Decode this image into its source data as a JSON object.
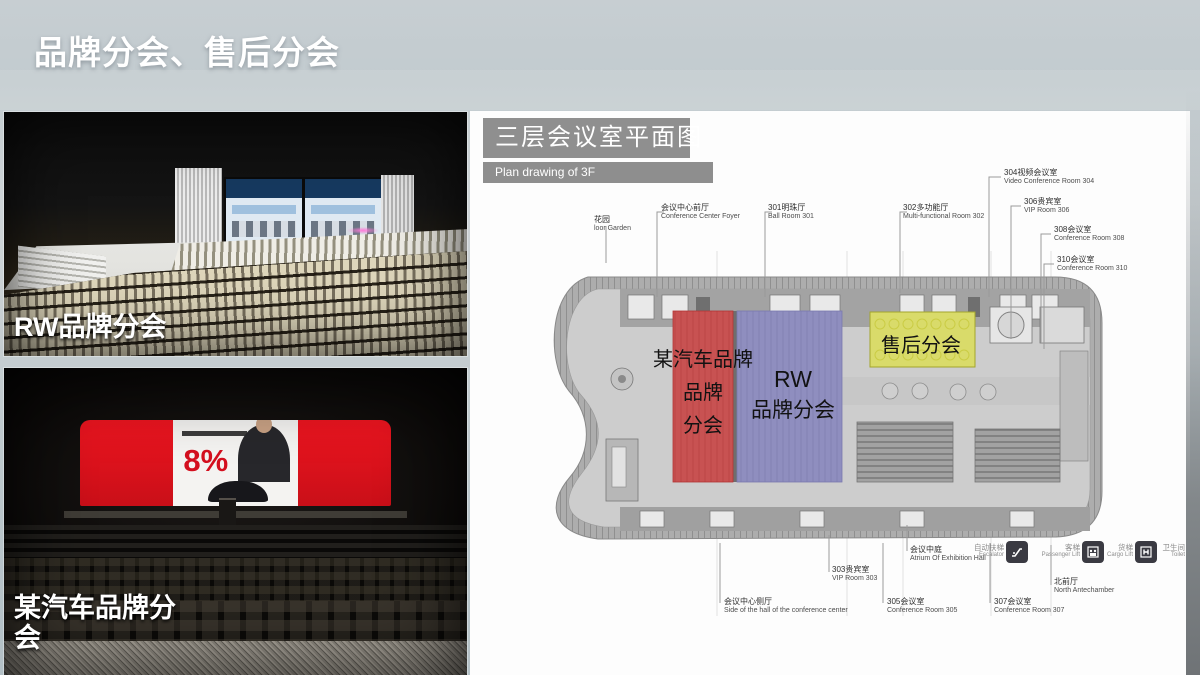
{
  "slide": {
    "title": "品牌分会、售后分会"
  },
  "photos": {
    "rw": {
      "label": "RW品牌分会"
    },
    "brand": {
      "label": "某汽车品牌分会",
      "screen_stat": "8%"
    }
  },
  "plan": {
    "title_zh": "三层会议室平面图",
    "title_en": "Plan drawing of 3F",
    "regions": {
      "brand": {
        "lines": [
          "某汽车品牌",
          "品牌",
          "分会"
        ],
        "color": "#d54e4e"
      },
      "rw": {
        "lines": [
          "RW",
          "品牌分会"
        ],
        "color": "#8f8ec8"
      },
      "after_sales": {
        "lines": [
          "售后分会"
        ],
        "color": "#dde04f"
      }
    },
    "labels": {
      "garden": {
        "zh": "花园",
        "en": "loor Garden"
      },
      "foyer": {
        "zh": "会议中心前厅",
        "en": "Conference Center Foyer"
      },
      "room301": {
        "zh": "301明珠厅",
        "en": "Ball Room 301"
      },
      "room302": {
        "zh": "302多功能厅",
        "en": "Multi-functional Room 302"
      },
      "room304": {
        "zh": "304视频会议室",
        "en": "Video Conference Room 304"
      },
      "room306": {
        "zh": "306贵宾室",
        "en": "VIP Room 306"
      },
      "room308": {
        "zh": "308会议室",
        "en": "Conference Room 308"
      },
      "room310": {
        "zh": "310会议室",
        "en": "Conference Room 310"
      },
      "side_hall": {
        "zh": "会议中心侧厅",
        "en": "Side of the hall of the conference center"
      },
      "room303": {
        "zh": "303贵宾室",
        "en": "VIP Room 303"
      },
      "room305": {
        "zh": "305会议室",
        "en": "Conference Room 305"
      },
      "atrium": {
        "zh": "会议中庭",
        "en": "Atrium Of Exhibition Hall"
      },
      "room307": {
        "zh": "307会议室",
        "en": "Conference Room 307"
      },
      "north": {
        "zh": "北前厅",
        "en": "North Antechamber"
      }
    },
    "legend": [
      {
        "zh": "自动扶梯",
        "en": "Escalator"
      },
      {
        "zh": "客梯",
        "en": "Passenger Lift"
      },
      {
        "zh": "货梯",
        "en": "Cargo Lift"
      },
      {
        "zh": "卫生间",
        "en": "Toilet"
      }
    ]
  }
}
